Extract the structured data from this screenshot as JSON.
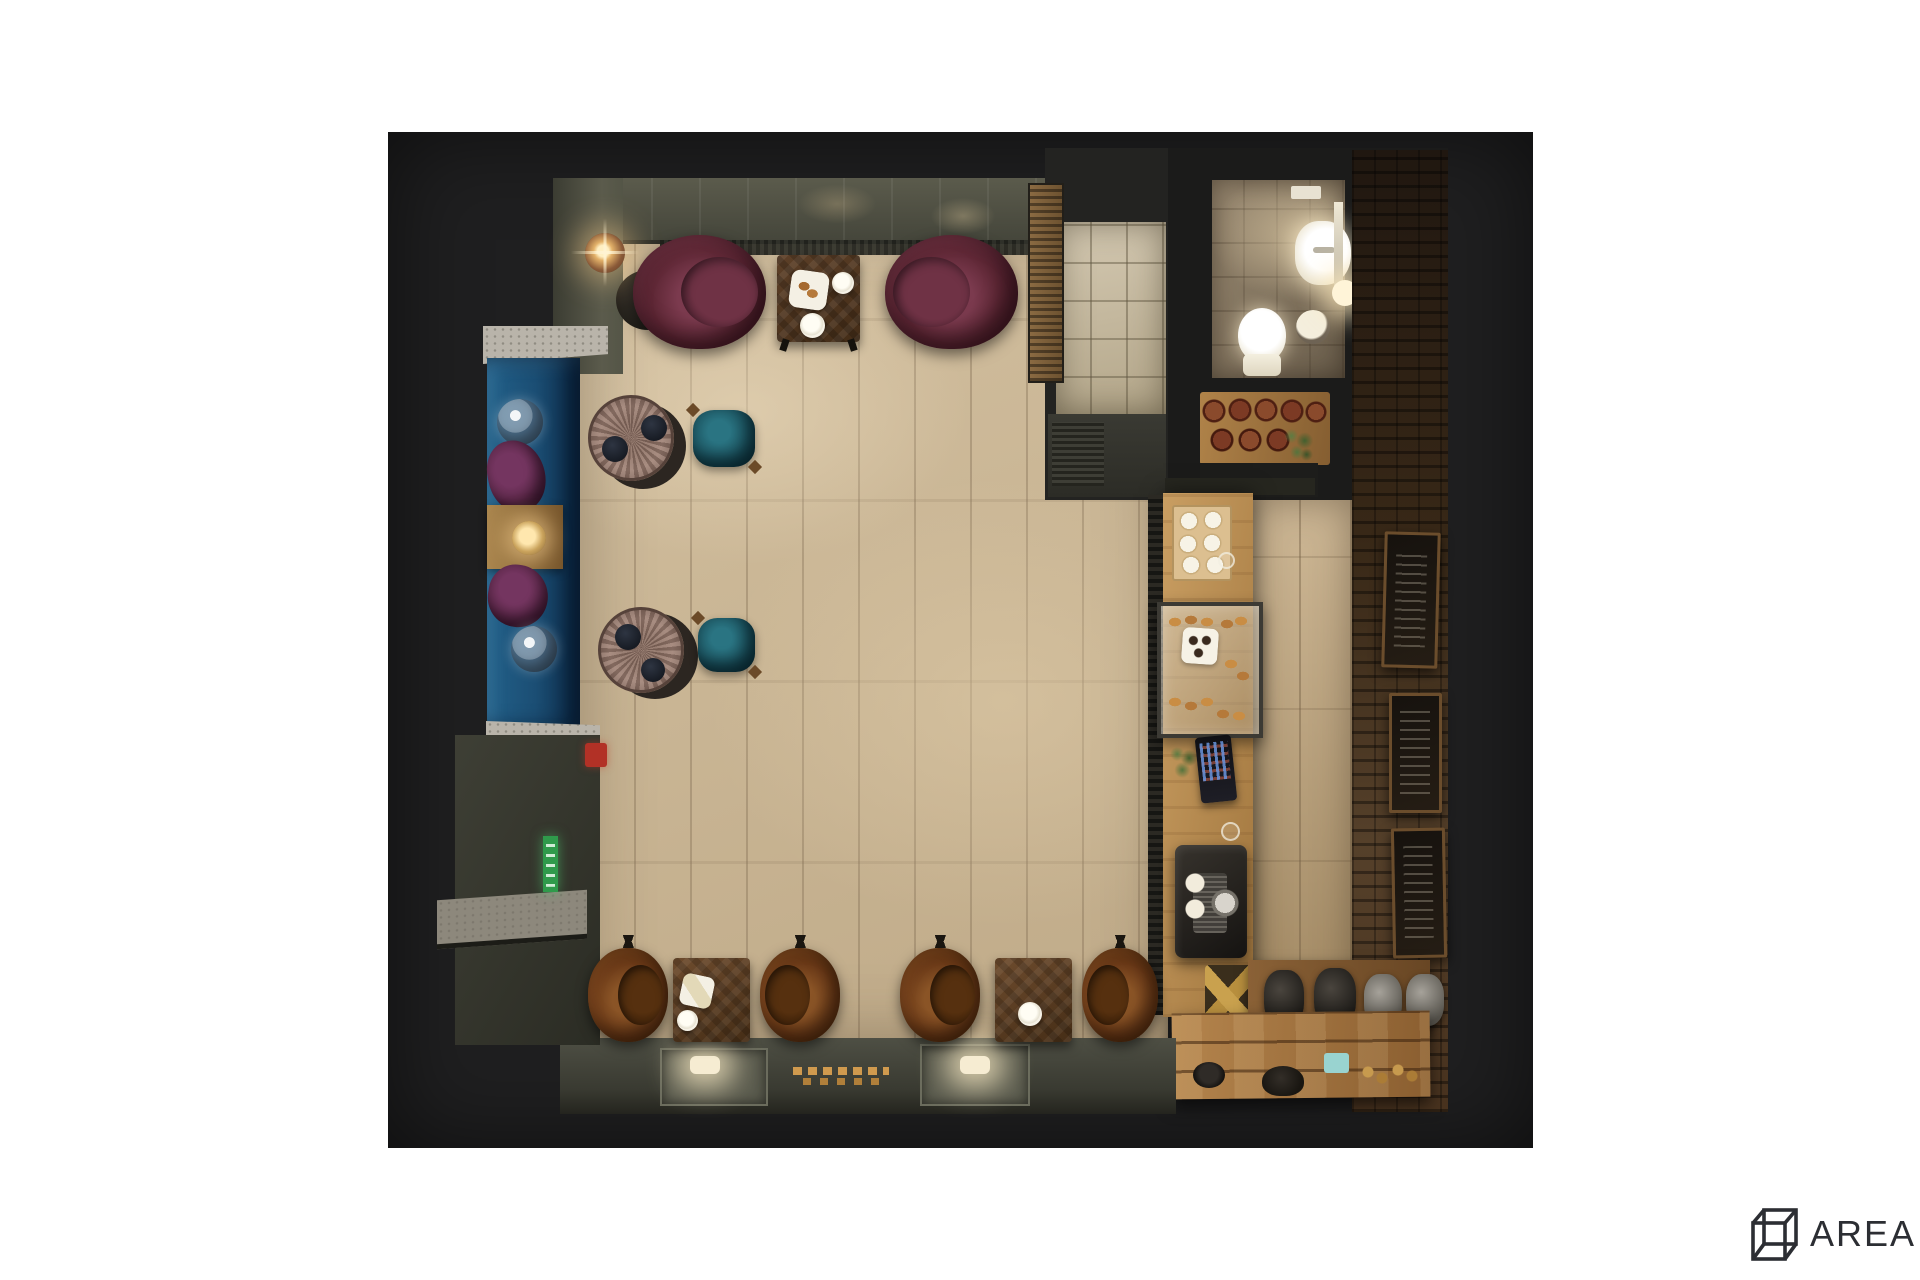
{
  "brand": {
    "logo_text": "AREA",
    "logo_sup": "2"
  },
  "palette": {
    "page_bg": "#ffffff",
    "panel": "#1f1f20",
    "wall": "#5b5b4c",
    "wall_dark": "#2b2c24",
    "floor": "#d2bf9f",
    "entry_tile": "#d4c9b2",
    "banquette_blue": "#1b4e74",
    "terrazzo": "#b9b4aa",
    "granite": "#8d887c",
    "burgundy": "#5e2735",
    "plum": "#5a2747",
    "teal": "#1b525e",
    "copper_table": "#9c8074",
    "brown_leather": "#6b3a18",
    "walnut": "#5d4028",
    "oak": "#c99e62",
    "plank": "#b5854d",
    "brick": "#201710",
    "bath_floor": "#9a8a72",
    "olive_floor": "#4e4f44",
    "steel": "#a6a29a",
    "gold": "#d09a4e",
    "exit_green": "#2f9a4b",
    "ext_red": "#b23126",
    "logo_ink": "#2c2e33"
  },
  "scene": {
    "description": "Top-down 3D render of a small coffee shop interior on a dark board, white page background, AREA2 logo watermark bottom right",
    "elements": [
      "olive paneled top wall with warm ceiling light glows and radiator",
      "beige plank-tile main floor",
      "floor lamp and two burgundy velvet armchairs with walnut coffee table and white plates",
      "slatted wood partition and entry vestibule with square tile floor and louvered door",
      "restroom with glowing sink, mirror, toilet, round stool and wall light",
      "wood shelf with rust-colored mugs and a plant",
      "dark brick wall with three framed chalkboard menus",
      "oak service counter with cup tray, glass pastry display case, plate of rolls, plant, POS register, water glasses and espresso machine",
      "back bar with gold bottle rack, kettles and grinders on wood shelf, rustic plank counter, mug, teapot, blue box and gold bits",
      "blue velvet banquette with terrazzo ledges, two glass globes, two plum cushions, wood tray table with lit lamp",
      "two weathered copper round tables with dark stools and two teal stools",
      "four brown leather dining chairs and two walnut tables with plates along bottom wall",
      "olive floor strip with two recessed lit hatches and scattered golden letters",
      "bottom-left service counter with granite end, green exit sign and red fire extinguisher"
    ]
  }
}
